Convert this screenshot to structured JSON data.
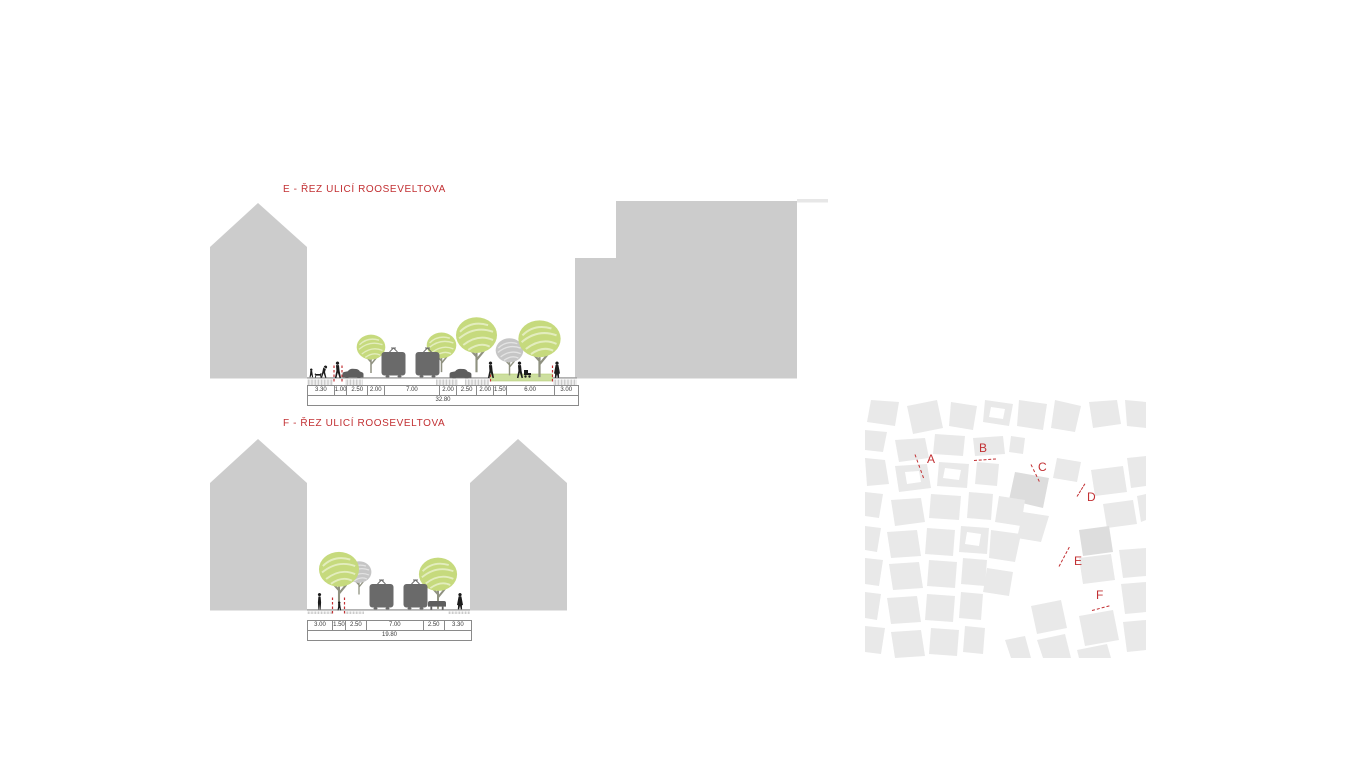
{
  "sections": [
    {
      "id": "E",
      "title": "E - ŘEZ ULICÍ ROOSEVELTOVA",
      "dimensions": [
        "3.30",
        "1.00",
        "2.50",
        "2.00",
        "7.00",
        "2.00",
        "2.50",
        "2.00",
        "1.50",
        "6.00",
        "3.00"
      ],
      "total": "32.80"
    },
    {
      "id": "F",
      "title": "F - ŘEZ ULICÍ ROOSEVELTOVA",
      "dimensions": [
        "3.00",
        "1.50",
        "2.50",
        "7.00",
        "2.50",
        "3.30"
      ],
      "total": "19.80"
    }
  ],
  "map": {
    "markers": [
      {
        "label": "A"
      },
      {
        "label": "B"
      },
      {
        "label": "C"
      },
      {
        "label": "D"
      },
      {
        "label": "E"
      },
      {
        "label": "F"
      }
    ]
  },
  "colors": {
    "accent_red": "#c23033",
    "building_gray": "#cccccc",
    "map_block_gray": "#e9e9e9",
    "tree_green": "#c6da7d",
    "gray_tree": "#c6c6c6",
    "vehicle_gray": "#6a6a6a",
    "figure_black": "#1c1c1c",
    "green_strip": "#cddf9f"
  }
}
